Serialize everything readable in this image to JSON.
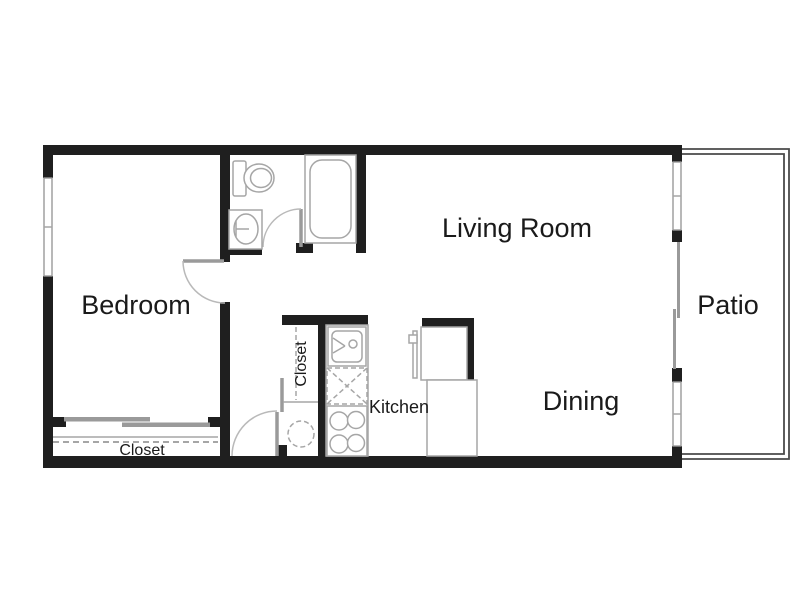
{
  "title": "Apartment floor plan",
  "rooms": {
    "bedroom": "Bedroom",
    "living_room": "Living Room",
    "dining": "Dining",
    "kitchen": "Kitchen",
    "patio": "Patio",
    "bedroom_closet": "Closet",
    "hall_closet": "Closet"
  },
  "fixtures": [
    "toilet",
    "bathroom-sink",
    "bathtub",
    "kitchen-sink",
    "dishwasher",
    "range",
    "refrigerator",
    "counter",
    "water-heater",
    "window",
    "sliding-glass-door",
    "door-swing",
    "closet-shelf",
    "closet-rod"
  ],
  "colors": {
    "wall": "#1f1f1f",
    "fixture_outline": "#a6a6a6",
    "door": "#9a9a9a",
    "patio_outline": "#4a4a4a",
    "text": "#1a1a1a",
    "background": "#ffffff"
  }
}
